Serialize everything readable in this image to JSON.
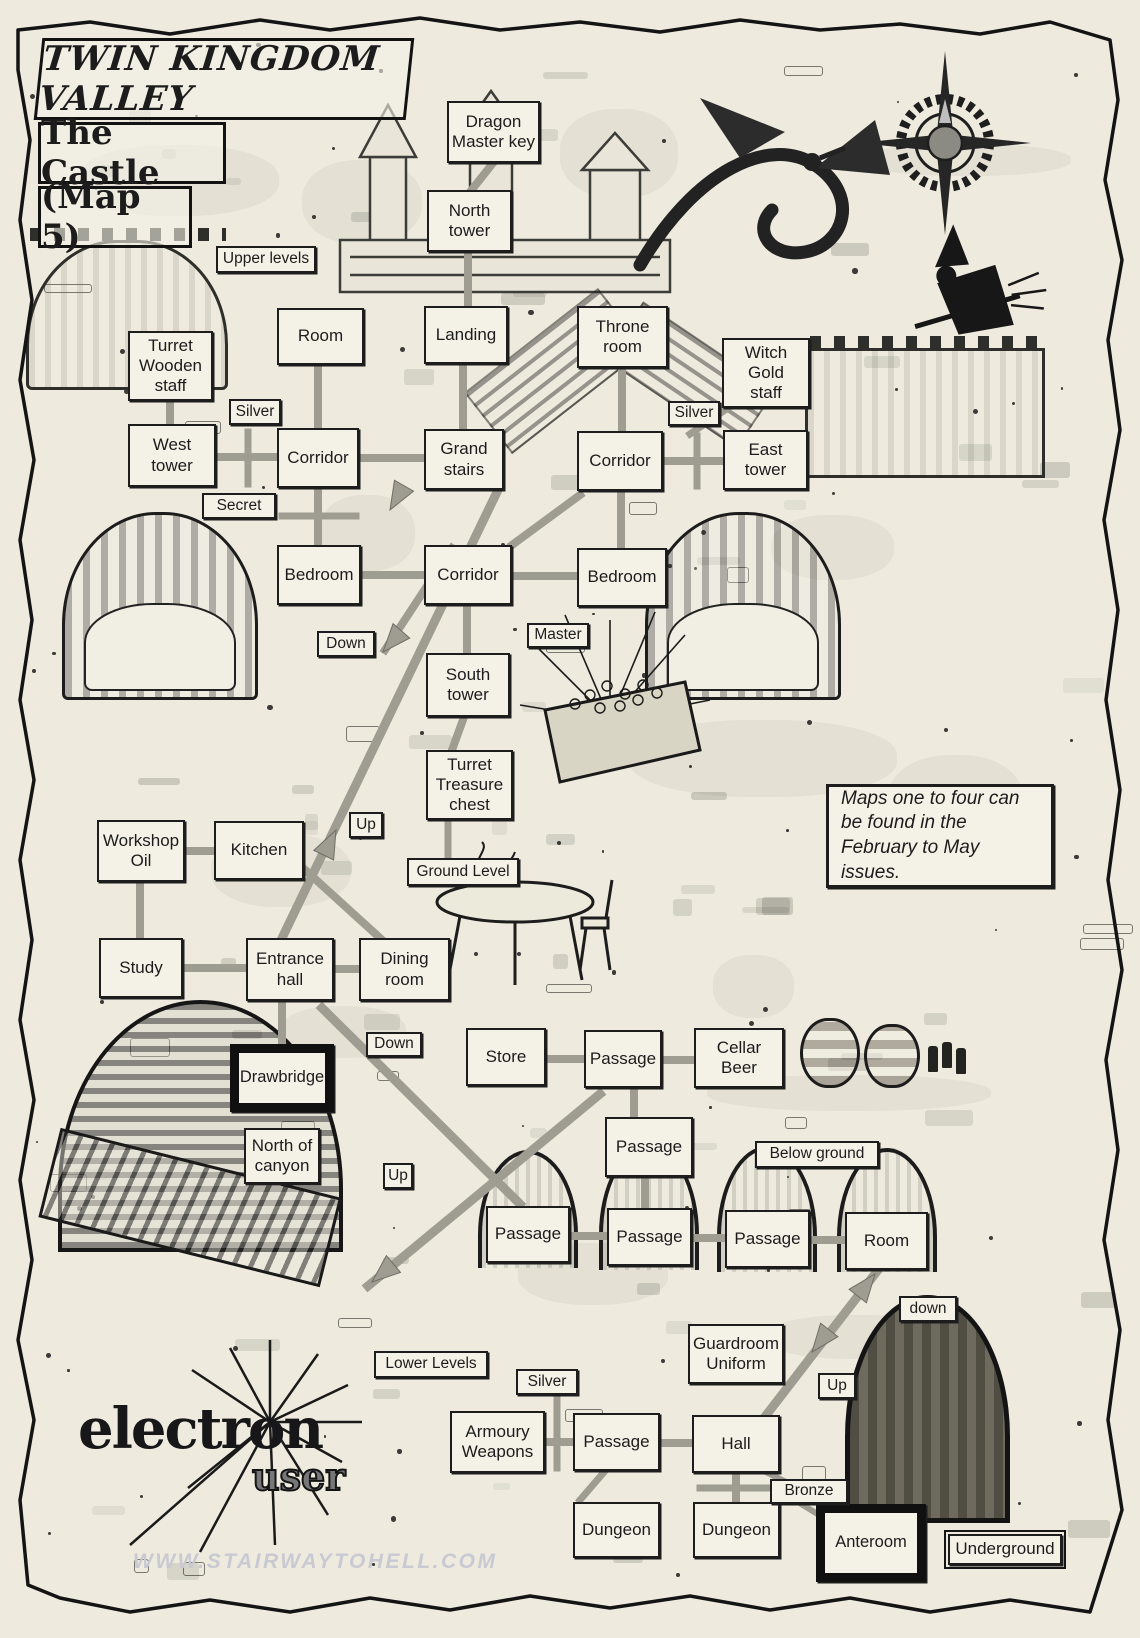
{
  "page": {
    "title_main": "TWIN KINGDOM VALLEY",
    "title_sub": "The Castle",
    "title_map": "(Map 5)"
  },
  "info_box": {
    "text": "Maps one to four can be found in the February to May issues."
  },
  "logo": {
    "line1": "electron",
    "line2": "user"
  },
  "watermark": "WWW.STAIRWAYTOHELL.COM",
  "colors": {
    "paper": "#eeebde",
    "box_fill": "#f4f1e6",
    "ink": "#1c1c1c",
    "connector": "#9f9c91",
    "watermark": "#c8c9d2"
  },
  "nodes": [
    {
      "id": "room-dragon-master-key",
      "label": "Dragon\nMaster key",
      "x": 447,
      "y": 101,
      "w": 93,
      "h": 62,
      "type": "room"
    },
    {
      "id": "room-north-tower",
      "label": "North\ntower",
      "x": 427,
      "y": 190,
      "w": 85,
      "h": 62,
      "type": "room"
    },
    {
      "id": "room-upper-room",
      "label": "Room",
      "x": 277,
      "y": 308,
      "w": 87,
      "h": 57,
      "type": "room"
    },
    {
      "id": "room-landing",
      "label": "Landing",
      "x": 424,
      "y": 306,
      "w": 84,
      "h": 58,
      "type": "room"
    },
    {
      "id": "room-throne-room",
      "label": "Throne\nroom",
      "x": 577,
      "y": 306,
      "w": 91,
      "h": 62,
      "type": "room"
    },
    {
      "id": "room-witch-gold-staff",
      "label": "Witch\nGold\nstaff",
      "x": 722,
      "y": 338,
      "w": 88,
      "h": 70,
      "type": "room"
    },
    {
      "id": "room-turret-wooden-staff",
      "label": "Turret\nWooden\nstaff",
      "x": 128,
      "y": 331,
      "w": 85,
      "h": 70,
      "type": "room"
    },
    {
      "id": "room-west-tower",
      "label": "West\ntower",
      "x": 128,
      "y": 424,
      "w": 88,
      "h": 63,
      "type": "room"
    },
    {
      "id": "room-corridor-west",
      "label": "Corridor",
      "x": 277,
      "y": 428,
      "w": 82,
      "h": 60,
      "type": "room"
    },
    {
      "id": "room-grand-stairs",
      "label": "Grand\nstairs",
      "x": 424,
      "y": 429,
      "w": 80,
      "h": 61,
      "type": "room"
    },
    {
      "id": "room-corridor-east",
      "label": "Corridor",
      "x": 577,
      "y": 431,
      "w": 86,
      "h": 60,
      "type": "room"
    },
    {
      "id": "room-east-tower",
      "label": "East\ntower",
      "x": 723,
      "y": 430,
      "w": 85,
      "h": 60,
      "type": "room"
    },
    {
      "id": "room-bedroom-west",
      "label": "Bedroom",
      "x": 277,
      "y": 545,
      "w": 84,
      "h": 60,
      "type": "room"
    },
    {
      "id": "room-corridor-mid",
      "label": "Corridor",
      "x": 424,
      "y": 545,
      "w": 88,
      "h": 60,
      "type": "room"
    },
    {
      "id": "room-bedroom-east",
      "label": "Bedroom",
      "x": 577,
      "y": 548,
      "w": 90,
      "h": 59,
      "type": "room"
    },
    {
      "id": "room-south-tower",
      "label": "South\ntower",
      "x": 426,
      "y": 653,
      "w": 84,
      "h": 64,
      "type": "room"
    },
    {
      "id": "room-turret-treasure-chest",
      "label": "Turret\nTreasure\nchest",
      "x": 426,
      "y": 750,
      "w": 87,
      "h": 70,
      "type": "room"
    },
    {
      "id": "room-workshop-oil",
      "label": "Workshop\nOil",
      "x": 97,
      "y": 820,
      "w": 88,
      "h": 62,
      "type": "room"
    },
    {
      "id": "room-kitchen",
      "label": "Kitchen",
      "x": 214,
      "y": 821,
      "w": 90,
      "h": 59,
      "type": "room"
    },
    {
      "id": "room-study",
      "label": "Study",
      "x": 99,
      "y": 938,
      "w": 84,
      "h": 60,
      "type": "room"
    },
    {
      "id": "room-entrance-hall",
      "label": "Entrance\nhall",
      "x": 246,
      "y": 938,
      "w": 88,
      "h": 63,
      "type": "room"
    },
    {
      "id": "room-dining-room",
      "label": "Dining\nroom",
      "x": 359,
      "y": 938,
      "w": 91,
      "h": 63,
      "type": "room"
    },
    {
      "id": "room-store",
      "label": "Store",
      "x": 466,
      "y": 1028,
      "w": 80,
      "h": 58,
      "type": "room"
    },
    {
      "id": "room-passage-1",
      "label": "Passage",
      "x": 584,
      "y": 1030,
      "w": 78,
      "h": 58,
      "type": "room"
    },
    {
      "id": "room-cellar-beer",
      "label": "Cellar\nBeer",
      "x": 694,
      "y": 1028,
      "w": 90,
      "h": 60,
      "type": "room"
    },
    {
      "id": "room-north-of-canyon",
      "label": "North of\ncanyon",
      "x": 244,
      "y": 1128,
      "w": 76,
      "h": 56,
      "type": "room"
    },
    {
      "id": "room-passage-2",
      "label": "Passage",
      "x": 605,
      "y": 1117,
      "w": 88,
      "h": 60,
      "type": "room"
    },
    {
      "id": "room-passage-3",
      "label": "Passage",
      "x": 486,
      "y": 1206,
      "w": 84,
      "h": 57,
      "type": "room"
    },
    {
      "id": "room-passage-4",
      "label": "Passage",
      "x": 607,
      "y": 1208,
      "w": 85,
      "h": 58,
      "type": "room"
    },
    {
      "id": "room-passage-5",
      "label": "Passage",
      "x": 725,
      "y": 1210,
      "w": 85,
      "h": 58,
      "type": "room"
    },
    {
      "id": "room-lower-room",
      "label": "Room",
      "x": 845,
      "y": 1212,
      "w": 83,
      "h": 58,
      "type": "room"
    },
    {
      "id": "room-guardroom-uniform",
      "label": "Guardroom\nUniform",
      "x": 688,
      "y": 1324,
      "w": 96,
      "h": 60,
      "type": "room"
    },
    {
      "id": "room-armoury-weapons",
      "label": "Armoury\nWeapons",
      "x": 450,
      "y": 1411,
      "w": 95,
      "h": 62,
      "type": "room"
    },
    {
      "id": "room-passage-6",
      "label": "Passage",
      "x": 573,
      "y": 1413,
      "w": 87,
      "h": 58,
      "type": "room"
    },
    {
      "id": "room-hall",
      "label": "Hall",
      "x": 692,
      "y": 1415,
      "w": 88,
      "h": 58,
      "type": "room"
    },
    {
      "id": "room-dungeon-west",
      "label": "Dungeon",
      "x": 573,
      "y": 1502,
      "w": 87,
      "h": 56,
      "type": "room"
    },
    {
      "id": "room-dungeon-east",
      "label": "Dungeon",
      "x": 693,
      "y": 1502,
      "w": 87,
      "h": 56,
      "type": "room"
    },
    {
      "id": "room-drawbridge",
      "label": "Drawbridge",
      "x": 230,
      "y": 1044,
      "w": 104,
      "h": 68,
      "type": "bold"
    },
    {
      "id": "room-anteroom",
      "label": "Anteroom",
      "x": 816,
      "y": 1504,
      "w": 110,
      "h": 78,
      "type": "bold"
    },
    {
      "id": "tag-upper-levels",
      "label": "Upper levels",
      "x": 216,
      "y": 246,
      "w": 100,
      "h": 27,
      "type": "tag"
    },
    {
      "id": "tag-silver-northwest",
      "label": "Silver",
      "x": 229,
      "y": 399,
      "w": 52,
      "h": 26,
      "type": "tag"
    },
    {
      "id": "tag-secret",
      "label": "Secret",
      "x": 202,
      "y": 493,
      "w": 74,
      "h": 26,
      "type": "tag"
    },
    {
      "id": "tag-silver-northeast",
      "label": "Silver",
      "x": 668,
      "y": 401,
      "w": 52,
      "h": 25,
      "type": "tag"
    },
    {
      "id": "tag-down-upper",
      "label": "Down",
      "x": 317,
      "y": 631,
      "w": 58,
      "h": 26,
      "type": "tag"
    },
    {
      "id": "tag-master",
      "label": "Master",
      "x": 527,
      "y": 623,
      "w": 62,
      "h": 25,
      "type": "tag"
    },
    {
      "id": "tag-up-mid",
      "label": "Up",
      "x": 349,
      "y": 812,
      "w": 34,
      "h": 26,
      "type": "tag"
    },
    {
      "id": "tag-ground-level",
      "label": "Ground Level",
      "x": 407,
      "y": 858,
      "w": 112,
      "h": 28,
      "type": "tag"
    },
    {
      "id": "tag-down-cellar",
      "label": "Down",
      "x": 366,
      "y": 1032,
      "w": 56,
      "h": 25,
      "type": "tag"
    },
    {
      "id": "tag-up-lower",
      "label": "Up",
      "x": 383,
      "y": 1163,
      "w": 30,
      "h": 26,
      "type": "tag"
    },
    {
      "id": "tag-below-ground",
      "label": "Below ground",
      "x": 755,
      "y": 1141,
      "w": 124,
      "h": 27,
      "type": "tag"
    },
    {
      "id": "tag-down-southeast",
      "label": "down",
      "x": 899,
      "y": 1296,
      "w": 58,
      "h": 26,
      "type": "tag"
    },
    {
      "id": "tag-up-southeast",
      "label": "Up",
      "x": 818,
      "y": 1373,
      "w": 38,
      "h": 26,
      "type": "tag"
    },
    {
      "id": "tag-lower-levels",
      "label": "Lower Levels",
      "x": 374,
      "y": 1351,
      "w": 114,
      "h": 27,
      "type": "tag"
    },
    {
      "id": "tag-silver-south",
      "label": "Silver",
      "x": 516,
      "y": 1369,
      "w": 62,
      "h": 26,
      "type": "tag"
    },
    {
      "id": "tag-bronze",
      "label": "Bronze",
      "x": 770,
      "y": 1479,
      "w": 78,
      "h": 25,
      "type": "tag"
    },
    {
      "id": "tag-underground",
      "label": "Underground",
      "x": 948,
      "y": 1534,
      "w": 114,
      "h": 31,
      "type": "tag-double"
    },
    {
      "id": "maps-info-box",
      "label": "Maps one to four can be found in the February to May issues.",
      "x": 826,
      "y": 784,
      "w": 228,
      "h": 104,
      "type": "info"
    }
  ],
  "connectors": [
    [
      493,
      163,
      470,
      192,
      8
    ],
    [
      468,
      252,
      468,
      306,
      8
    ],
    [
      318,
      365,
      318,
      428,
      8
    ],
    [
      170,
      401,
      170,
      424,
      8
    ],
    [
      216,
      457,
      277,
      457,
      8
    ],
    [
      357,
      458,
      424,
      458,
      8
    ],
    [
      463,
      367,
      463,
      429,
      8
    ],
    [
      622,
      368,
      622,
      431,
      8
    ],
    [
      663,
      461,
      723,
      461,
      8
    ],
    [
      728,
      408,
      690,
      434,
      7
    ],
    [
      248,
      432,
      248,
      484,
      7
    ],
    [
      697,
      436,
      697,
      486,
      7
    ],
    [
      361,
      575,
      424,
      575,
      8
    ],
    [
      512,
      576,
      577,
      576,
      8
    ],
    [
      318,
      488,
      318,
      545,
      8
    ],
    [
      282,
      516,
      356,
      516,
      7
    ],
    [
      621,
      491,
      621,
      548,
      8
    ],
    [
      467,
      605,
      467,
      653,
      8
    ],
    [
      464,
      717,
      452,
      750,
      8
    ],
    [
      448,
      820,
      448,
      856,
      7
    ],
    [
      497,
      492,
      283,
      936,
      9
    ],
    [
      452,
      548,
      385,
      650,
      8
    ],
    [
      512,
      545,
      580,
      495,
      8
    ],
    [
      185,
      851,
      214,
      851,
      8
    ],
    [
      140,
      882,
      140,
      938,
      8
    ],
    [
      183,
      968,
      246,
      968,
      8
    ],
    [
      334,
      969,
      359,
      969,
      8
    ],
    [
      303,
      868,
      380,
      938,
      8
    ],
    [
      282,
      1001,
      282,
      1044,
      8
    ],
    [
      322,
      1008,
      520,
      1204,
      9
    ],
    [
      600,
      1094,
      368,
      1286,
      9
    ],
    [
      546,
      1059,
      584,
      1059,
      8
    ],
    [
      662,
      1060,
      694,
      1060,
      8
    ],
    [
      634,
      1088,
      634,
      1117,
      8
    ],
    [
      645,
      1177,
      645,
      1208,
      8
    ],
    [
      570,
      1236,
      607,
      1236,
      8
    ],
    [
      692,
      1238,
      725,
      1238,
      8
    ],
    [
      810,
      1240,
      845,
      1240,
      8
    ],
    [
      878,
      1270,
      764,
      1418,
      9
    ],
    [
      557,
      1397,
      557,
      1468,
      7
    ],
    [
      545,
      1442,
      573,
      1442,
      8
    ],
    [
      660,
      1443,
      692,
      1443,
      8
    ],
    [
      736,
      1473,
      736,
      1502,
      8
    ],
    [
      700,
      1488,
      770,
      1488,
      7
    ],
    [
      605,
      1471,
      580,
      1500,
      7
    ],
    [
      758,
      1468,
      790,
      1484,
      6
    ],
    [
      798,
      1502,
      824,
      1518,
      6
    ]
  ],
  "arrows": [
    [
      383,
      652,
      131
    ],
    [
      336,
      830,
      296
    ],
    [
      372,
      1282,
      140
    ],
    [
      875,
      1274,
      308
    ],
    [
      812,
      1352,
      128
    ],
    [
      390,
      510,
      120
    ]
  ]
}
